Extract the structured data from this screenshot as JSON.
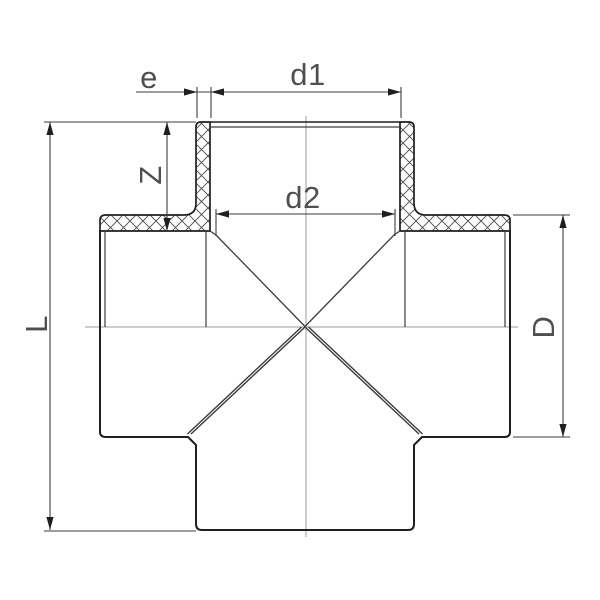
{
  "colors": {
    "background": "#ffffff",
    "line": "#1f1f1f",
    "thin": "#3c3c3c",
    "centerline": "#9b9b9b",
    "hatch": "#4a4a4a",
    "text": "#4f4f4f"
  },
  "dimensions": {
    "wall_thickness": {
      "label": "e"
    },
    "socket_outer_diameter": {
      "label": "d1"
    },
    "socket_inner_diameter": {
      "label": "d2"
    },
    "socket_depth": {
      "label": "Z"
    },
    "overall_length": {
      "label": "L"
    },
    "body_outer_diameter": {
      "label": "D"
    }
  }
}
